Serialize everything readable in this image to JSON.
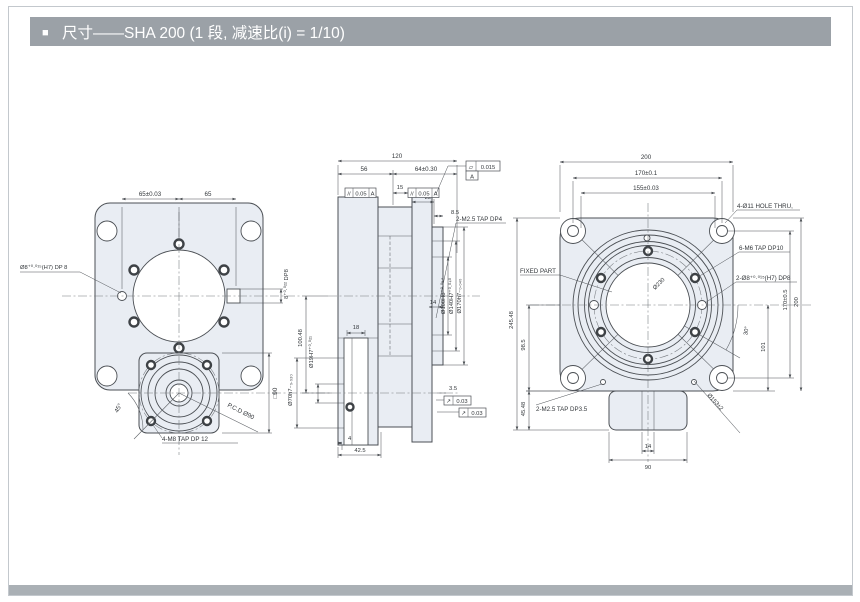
{
  "header": {
    "bullet": "■",
    "title": "尺寸——SHA 200 (1 段, 减速比(i) = 1/10)"
  },
  "colors": {
    "header_bg": "#9ba1a7",
    "header_text": "#ffffff",
    "bottom_bar": "#aab0b5",
    "page_border": "#c3c8cd",
    "line": "#4b4f54",
    "part_fill": "#e9edf3"
  },
  "front_view": {
    "dim_65_tol": "65±0.03",
    "dim_65": "65",
    "pin_hole": "Ø8⁺⁰·⁰¹⁵(H7) DP 8",
    "key_slot": "8⁺⁰·⁰²² DP8",
    "angle_45": "45°",
    "pcd": "P.C.D Ø90",
    "square_90": "□90",
    "motor_taps": "4-M8 TAP DP 12"
  },
  "side_view": {
    "dim_120": "120",
    "dim_56": "56",
    "dim_64": "64±0.30",
    "flatness": {
      "symbol": "▱",
      "value": "0.015",
      "datum": "A"
    },
    "parallel_left": {
      "symbol": "//",
      "value": "0.05",
      "datum": "A"
    },
    "parallel_right": {
      "symbol": "//",
      "value": "0.05",
      "datum": "A"
    },
    "dim_15": "15",
    "dim_22": "22",
    "dim_8_5": "8.5",
    "taps": "2-M2.5 TAP DP4",
    "dia_70": "Ø70h7₋₀.₀₃₀",
    "dia_19": "Ø19H7⁺⁰·⁰²¹",
    "dim_100_48": "100.48",
    "dim_18": "18",
    "dia_100": "Ø100H8⁺⁰·⁰⁵⁴",
    "dia_140": "Ø140H7⁺⁰·⁰⁴⁰",
    "dia_170": "Ø170h7₋₀.₀₄₀",
    "dim_14": "14",
    "dim_4": "4",
    "dim_42_5": "42.5",
    "dim_3_5": "3.5",
    "runout_1": {
      "symbol": "↗",
      "value": "0.03"
    },
    "runout_2": {
      "symbol": "↗",
      "value": "0.03"
    }
  },
  "back_view": {
    "dim_200": "200",
    "dim_170_tol": "170±0.1",
    "dim_155": "155±0.03",
    "holes": "4-Ø11 HOLE THRU,",
    "taps_m6": "6-M6 TAP DP10",
    "pins": "2-Ø8⁺⁰·⁰¹⁵(H7) DP8",
    "dim_170v": "170±0.5",
    "dim_200v": "200",
    "angle_30": "30°",
    "dim_101": "101",
    "fixed_part": "FIXED PART",
    "dim_245_48": "245.48",
    "dim_98_5": "98.5",
    "dim_45_48": "45.48",
    "taps_m2_5": "2-M2.5 TAP DP3.5",
    "dim_14": "14",
    "dim_90": "90",
    "dia_153": "Ø153±2",
    "dia_230": "Ø230"
  }
}
